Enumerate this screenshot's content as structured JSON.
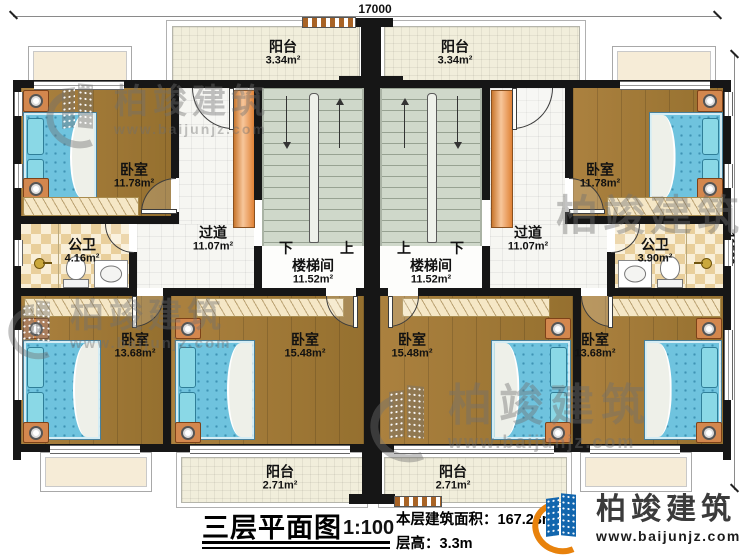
{
  "dimensions": {
    "top": "17000",
    "right": "11500"
  },
  "rooms": {
    "balcony_top_left": {
      "name": "阳台",
      "area": "3.34m²"
    },
    "balcony_top_right": {
      "name": "阳台",
      "area": "3.34m²"
    },
    "bedroom_top_left": {
      "name": "卧室",
      "area": "11.78m²"
    },
    "bedroom_top_right": {
      "name": "卧室",
      "area": "11.78m²"
    },
    "corridor_left": {
      "name": "过道",
      "area": "11.07m²"
    },
    "corridor_right": {
      "name": "过道",
      "area": "11.07m²"
    },
    "stairwell_left": {
      "name": "楼梯间",
      "area": "11.52m²"
    },
    "stairwell_right": {
      "name": "楼梯间",
      "area": "11.52m²"
    },
    "bathroom_left": {
      "name": "公卫",
      "area": "4.16m²"
    },
    "bathroom_right": {
      "name": "公卫",
      "area": "3.90m²"
    },
    "bedroom_bottom_far_left": {
      "name": "卧室",
      "area": "13.68m²"
    },
    "bedroom_bottom_mid_left": {
      "name": "卧室",
      "area": "15.48m²"
    },
    "bedroom_bottom_mid_right": {
      "name": "卧室",
      "area": "15.48m²"
    },
    "bedroom_bottom_far_right": {
      "name": "卧室",
      "area": "13.68m²"
    },
    "balcony_bottom_left": {
      "name": "阳台",
      "area": "2.71m²"
    },
    "balcony_bottom_right": {
      "name": "阳台",
      "area": "2.71m²"
    }
  },
  "stairs": {
    "left": {
      "west": "下",
      "east": "上"
    },
    "right": {
      "west": "上",
      "east": "下"
    }
  },
  "watermark": {
    "brand": "柏竣建筑",
    "url": "www.baijunjz.com"
  },
  "titleblock": {
    "title": "三层平面图",
    "scale": "1:100",
    "area_label": "本层建筑面积：",
    "area_value": "167.23m²",
    "height_label": "层高：",
    "height_value": "3.3m"
  },
  "logo": {
    "brand": "柏竣建筑",
    "url": "www.baijunjz.com"
  },
  "colors": {
    "wall": "#161616",
    "wood": "#a37a3b",
    "bed": "#6fc3de",
    "stairs": "#cfd8ca",
    "checker": "#e9cf9b",
    "balcony": "#f1eedb",
    "accent_orange": "#e8914d",
    "logo_blue": "#1266ae",
    "logo_orange": "#e8820c"
  }
}
